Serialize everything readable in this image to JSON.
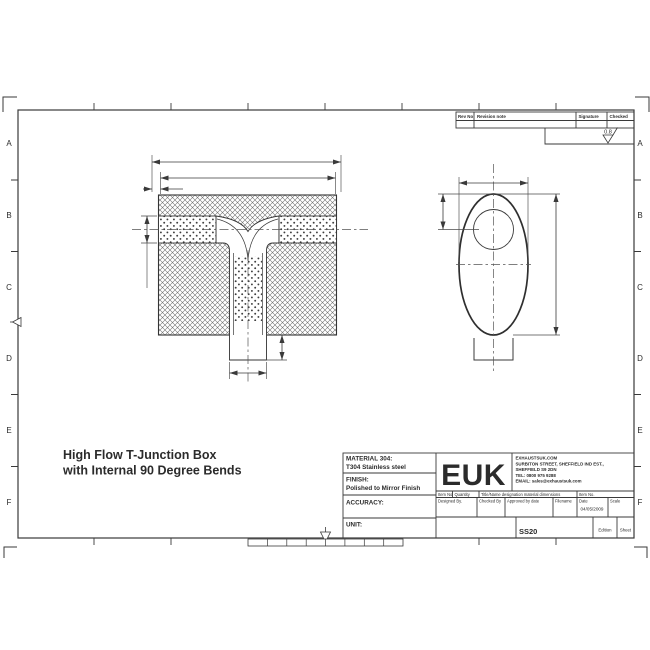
{
  "canvas": {
    "background": "#ffffff",
    "line_color": "#3a3a3a"
  },
  "zones": [
    "A",
    "B",
    "C",
    "D",
    "E",
    "F"
  ],
  "revision_table": {
    "col_rev_no": "Rev No",
    "col_revision_note": "Revision note",
    "col_signature": "Signature",
    "col_checked": "Checked"
  },
  "surface_finish": {
    "roughness": "0.8"
  },
  "drawing_title": {
    "line1": "High Flow T-Junction Box",
    "line2": "with Internal 90 Degree Bends"
  },
  "title_block": {
    "material_label": "MATERIAL 304:",
    "material_value": "T304 Stainless steel",
    "finish_label": "FINISH:",
    "finish_value": "Polished to Mirror Finish",
    "accuracy_label": "ACCURACY:",
    "unit_label": "UNIT:",
    "logo": "EUK",
    "company": {
      "line1": "EXHAUSTSUK.COM",
      "line2": "SURBITON STREET, SHEFFIELD IND EST.,",
      "line3": "SHEFFIELD S9 2DN",
      "line4": "TEL: 0800 975 9288",
      "line5": "EMAIL: sales@exhaustsuk.com"
    },
    "parts_row": {
      "item_no": "Item No",
      "quantity": "Quantity",
      "title_name": "Title/Name designation material dimensions",
      "item_no2": "Item No."
    },
    "approval_row": {
      "designed_by": "Designed By.",
      "checked_by": "Checked By",
      "approved_by": "Approved by date",
      "filename": "Filename",
      "date": "Date",
      "scale": "Scale"
    },
    "date_value": "04/05/2009",
    "part_number": "SS20",
    "edition_label": "Edition",
    "sheet_label": "Sheet"
  }
}
